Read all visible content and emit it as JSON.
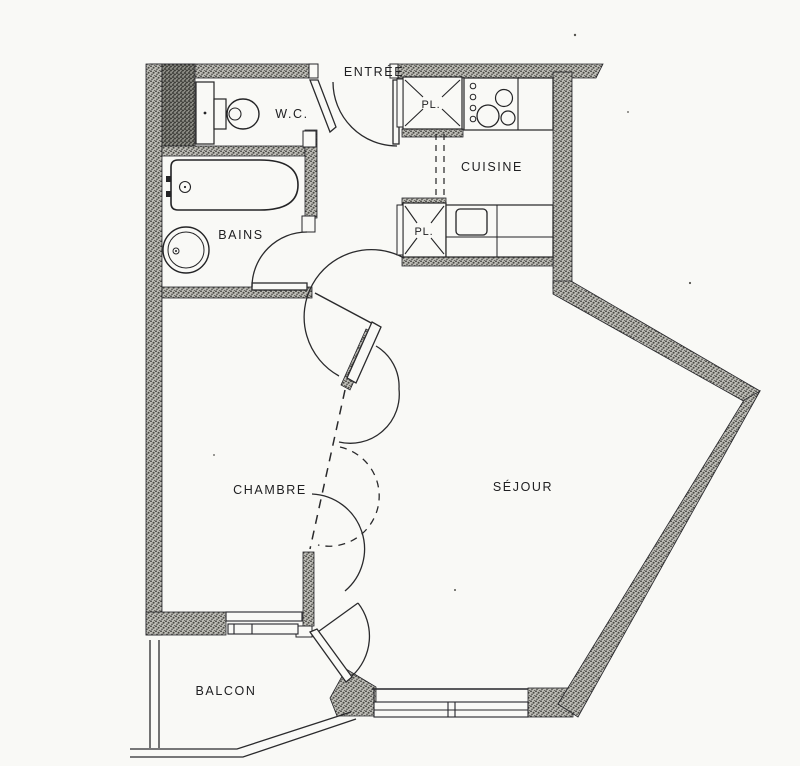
{
  "floor_plan": {
    "labels": {
      "entree": "ENTRÉE",
      "wc": "W.C.",
      "cuisine": "CUISINE",
      "placard_upper": "PL.",
      "placard_lower": "PL.",
      "bains": "BAINS",
      "chambre": "CHAMBRE",
      "sejour": "SÉJOUR",
      "balcon": "BALCON"
    },
    "colors": {
      "paper": "#f9f9f6",
      "ink": "#202022",
      "wall_speckle": "#b7b6b0",
      "wall_dark": "#77766e"
    }
  }
}
